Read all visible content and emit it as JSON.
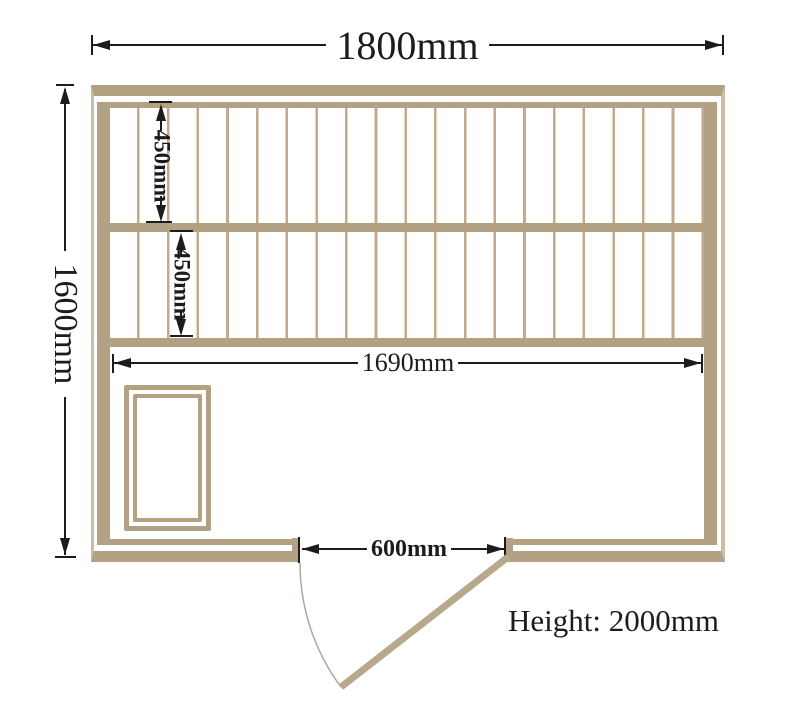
{
  "diagram": {
    "type": "sauna-room-floor-plan",
    "dimensions": {
      "overall_width": "1800mm",
      "overall_depth": "1600mm",
      "upper_bench_depth": "450mm",
      "lower_bench_depth": "450mm",
      "interior_width": "1690mm",
      "door_opening_width": "600mm"
    },
    "notes": {
      "height": "Height: 2000mm"
    },
    "colors": {
      "wood": "#b2a183",
      "wood_light": "#cbbca2",
      "slat": "#c3aa8e",
      "door_leaf": "#b8a98d",
      "swing_arc": "#b1a795",
      "dimension": "#1c1c1c",
      "background": "#ffffff"
    }
  }
}
